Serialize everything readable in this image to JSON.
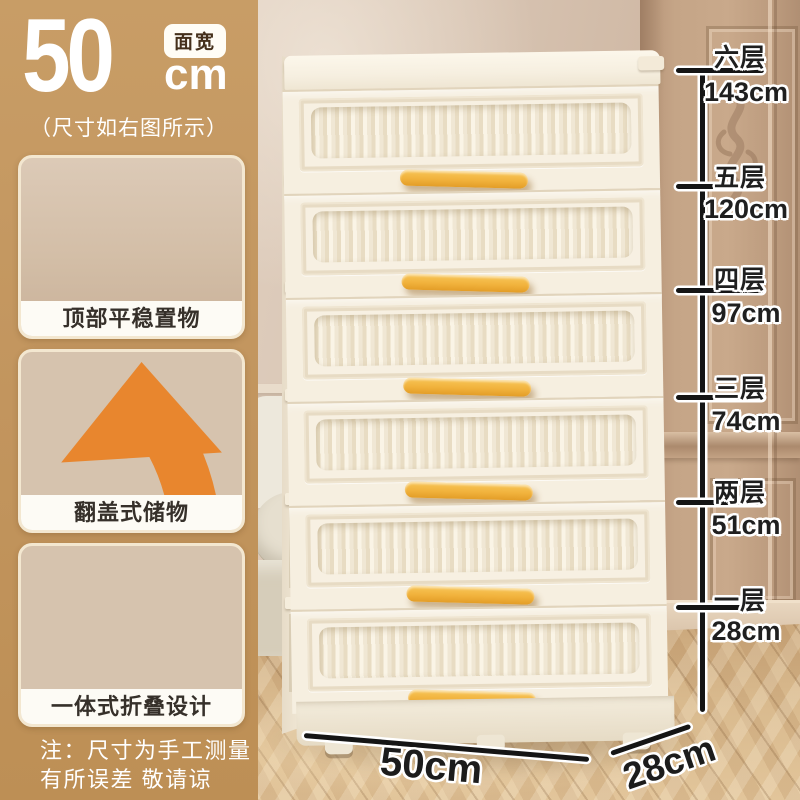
{
  "size_panel": {
    "value": "50",
    "unit": "cm",
    "badge": "面宽",
    "subtitle": "（尺寸如右图所示）",
    "panel_color": "#C2955E"
  },
  "features": [
    {
      "caption": "顶部平稳置物"
    },
    {
      "caption": "翻盖式储物"
    },
    {
      "caption": "一体式折叠设计"
    }
  ],
  "disclaimer": {
    "line1": "注：尺寸为手工测量",
    "line2": "有所误差 敬请谅解！"
  },
  "height_guide": {
    "entries": [
      {
        "tier": "六层",
        "height": "143cm"
      },
      {
        "tier": "五层",
        "height": "120cm"
      },
      {
        "tier": "四层",
        "height": "97cm"
      },
      {
        "tier": "三层",
        "height": "74cm"
      },
      {
        "tier": "两层",
        "height": "51cm"
      },
      {
        "tier": "一层",
        "height": "28cm"
      }
    ]
  },
  "footprint": {
    "width": "50cm",
    "depth": "28cm"
  },
  "product": {
    "tiers": 6,
    "handle_color": "#F1B23C",
    "body_color": "#F6EFE1",
    "line_color": "#151515"
  }
}
